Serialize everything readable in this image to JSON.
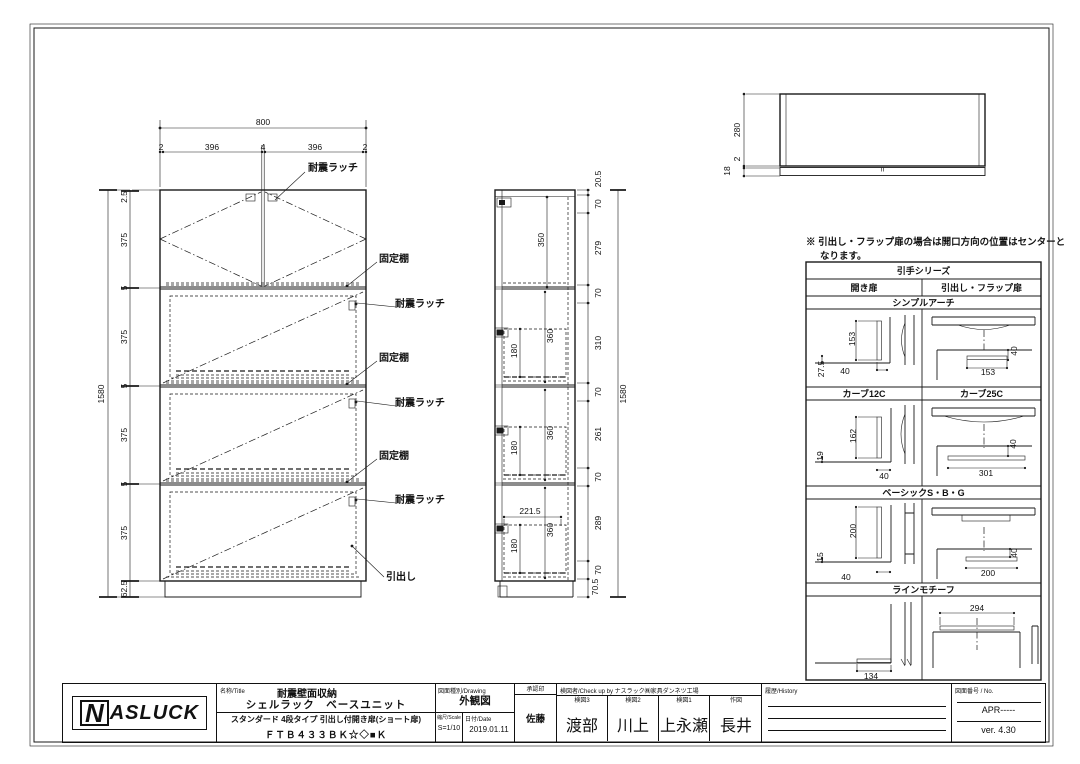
{
  "sheet": {
    "bg": "#ffffff",
    "line_color": "#1a1a1a"
  },
  "note": {
    "line1": "※ 引出し・フラップ扉の場合は開口方向の位置はセンターと",
    "line2": "なります。"
  },
  "handle_table": {
    "title": "引手シリーズ",
    "col_left": "開き扉",
    "col_right": "引出し・フラップ扉",
    "bands": [
      {
        "label": "シンプルアーチ"
      },
      {
        "label_left": "カーブ12C",
        "label_right": "カーブ25C"
      },
      {
        "label": "ベーシックS・B・G"
      },
      {
        "label": "ラインモチーフ"
      }
    ]
  },
  "title_block": {
    "logo_n": "N",
    "logo_rest": "ASLUCK",
    "name_label": "名称/Title",
    "name_line1": "耐震壁面収納",
    "name_line2": "シェルラック　ベースユニット",
    "name_line3": "スタンダード 4段タイプ 引出し付開き扉(ショート扉)",
    "name_line4": "ＦＴＢ４３３ＢＫ☆◇■Ｋ",
    "drawing_label": "図面種別/Drawing",
    "drawing_value": "外観図",
    "scale_label": "縮尺/Scale",
    "scale_value": "S=1/10",
    "date_label": "日付/Date",
    "date_value": "2019.01.11",
    "approval_label": "承認印",
    "approval_value": "佐藤",
    "check_label": "検図者/Check up by ナスラック㈱家具ダンネツ工場",
    "check_cols": [
      {
        "label": "検図3",
        "name": "渡部"
      },
      {
        "label": "検図2",
        "name": "川上"
      },
      {
        "label": "検図1",
        "name": "上永瀬"
      },
      {
        "label": "作図",
        "name": "長井"
      }
    ],
    "history_label": "履歴/History",
    "no_label": "図面番号 / No.",
    "no_value": "APR-----",
    "version": "ver. 4.30"
  },
  "annotations": [
    {
      "t": "800",
      "x": 263,
      "y": 122
    },
    {
      "t": "2",
      "x": 161,
      "y": 147
    },
    {
      "t": "396",
      "x": 212,
      "y": 147
    },
    {
      "t": "4",
      "x": 263,
      "y": 147
    },
    {
      "t": "396",
      "x": 315,
      "y": 147
    },
    {
      "t": "2",
      "x": 365,
      "y": 147
    },
    {
      "t": "耐震ラッチ",
      "x": 333,
      "y": 169,
      "b": 1,
      "s": 10,
      "n": "label-seismic-latch"
    },
    {
      "t": "固定棚",
      "x": 394,
      "y": 260,
      "b": 1,
      "s": 10,
      "n": "label-fixed-shelf"
    },
    {
      "t": "耐震ラッチ",
      "x": 420,
      "y": 305,
      "b": 1,
      "s": 10,
      "n": "label-seismic-latch"
    },
    {
      "t": "固定棚",
      "x": 394,
      "y": 359,
      "b": 1,
      "s": 10,
      "n": "label-fixed-shelf"
    },
    {
      "t": "耐震ラッチ",
      "x": 420,
      "y": 404,
      "b": 1,
      "s": 10,
      "n": "label-seismic-latch"
    },
    {
      "t": "固定棚",
      "x": 394,
      "y": 457,
      "b": 1,
      "s": 10,
      "n": "label-fixed-shelf"
    },
    {
      "t": "耐震ラッチ",
      "x": 420,
      "y": 501,
      "b": 1,
      "s": 10,
      "n": "label-seismic-latch"
    },
    {
      "t": "引出し",
      "x": 401,
      "y": 578,
      "b": 1,
      "s": 10,
      "n": "label-drawer"
    },
    {
      "t": "2.5",
      "x": 124,
      "y": 197,
      "r": 1
    },
    {
      "t": "375",
      "x": 124,
      "y": 240,
      "r": 1
    },
    {
      "t": "5",
      "x": 124,
      "y": 288,
      "r": 1
    },
    {
      "t": "375",
      "x": 124,
      "y": 337,
      "r": 1
    },
    {
      "t": "5",
      "x": 124,
      "y": 386,
      "r": 1
    },
    {
      "t": "375",
      "x": 124,
      "y": 435,
      "r": 1
    },
    {
      "t": "5",
      "x": 124,
      "y": 484,
      "r": 1
    },
    {
      "t": "375",
      "x": 124,
      "y": 533,
      "r": 1
    },
    {
      "t": "62.5",
      "x": 124,
      "y": 589,
      "r": 1
    },
    {
      "t": "1580",
      "x": 101,
      "y": 394,
      "r": 1
    },
    {
      "t": "350",
      "x": 541,
      "y": 240,
      "r": 1
    },
    {
      "t": "360",
      "x": 550,
      "y": 336,
      "r": 1
    },
    {
      "t": "180",
      "x": 514,
      "y": 351,
      "r": 1
    },
    {
      "t": "360",
      "x": 550,
      "y": 433,
      "r": 1
    },
    {
      "t": "180",
      "x": 514,
      "y": 448,
      "r": 1
    },
    {
      "t": "221.5",
      "x": 530,
      "y": 511
    },
    {
      "t": "360",
      "x": 550,
      "y": 530,
      "r": 1
    },
    {
      "t": "180",
      "x": 514,
      "y": 546,
      "r": 1
    },
    {
      "t": "20.5",
      "x": 598,
      "y": 179,
      "r": 1
    },
    {
      "t": "70",
      "x": 598,
      "y": 204,
      "r": 1
    },
    {
      "t": "279",
      "x": 598,
      "y": 248,
      "r": 1
    },
    {
      "t": "70",
      "x": 598,
      "y": 293,
      "r": 1
    },
    {
      "t": "310",
      "x": 598,
      "y": 343,
      "r": 1
    },
    {
      "t": "70",
      "x": 598,
      "y": 392,
      "r": 1
    },
    {
      "t": "261",
      "x": 598,
      "y": 434,
      "r": 1
    },
    {
      "t": "70",
      "x": 598,
      "y": 477,
      "r": 1
    },
    {
      "t": "289",
      "x": 598,
      "y": 523,
      "r": 1
    },
    {
      "t": "70",
      "x": 598,
      "y": 570,
      "r": 1
    },
    {
      "t": "70.5",
      "x": 595,
      "y": 587,
      "r": 1
    },
    {
      "t": "1580",
      "x": 623,
      "y": 394,
      "r": 1
    },
    {
      "t": "280",
      "x": 737,
      "y": 130,
      "r": 1
    },
    {
      "t": "2",
      "x": 737,
      "y": 159,
      "r": 1
    },
    {
      "t": "18",
      "x": 727,
      "y": 171,
      "r": 1
    },
    {
      "t": "153",
      "x": 852,
      "y": 339,
      "r": 1
    },
    {
      "t": "27.5",
      "x": 821,
      "y": 369,
      "r": 1
    },
    {
      "t": "40",
      "x": 845,
      "y": 371
    },
    {
      "t": "153",
      "x": 988,
      "y": 372
    },
    {
      "t": "40",
      "x": 1014,
      "y": 351,
      "r": 1
    },
    {
      "t": "162",
      "x": 853,
      "y": 436,
      "r": 1
    },
    {
      "t": "19",
      "x": 820,
      "y": 456,
      "r": 1
    },
    {
      "t": "40",
      "x": 884,
      "y": 476
    },
    {
      "t": "301",
      "x": 986,
      "y": 473
    },
    {
      "t": "40",
      "x": 1013,
      "y": 444,
      "r": 1
    },
    {
      "t": "200",
      "x": 853,
      "y": 531,
      "r": 1
    },
    {
      "t": "15",
      "x": 820,
      "y": 557,
      "r": 1
    },
    {
      "t": "40",
      "x": 846,
      "y": 577
    },
    {
      "t": "200",
      "x": 988,
      "y": 573
    },
    {
      "t": "40",
      "x": 1014,
      "y": 553,
      "r": 1
    },
    {
      "t": "134",
      "x": 871,
      "y": 676
    },
    {
      "t": "294",
      "x": 977,
      "y": 608
    }
  ]
}
